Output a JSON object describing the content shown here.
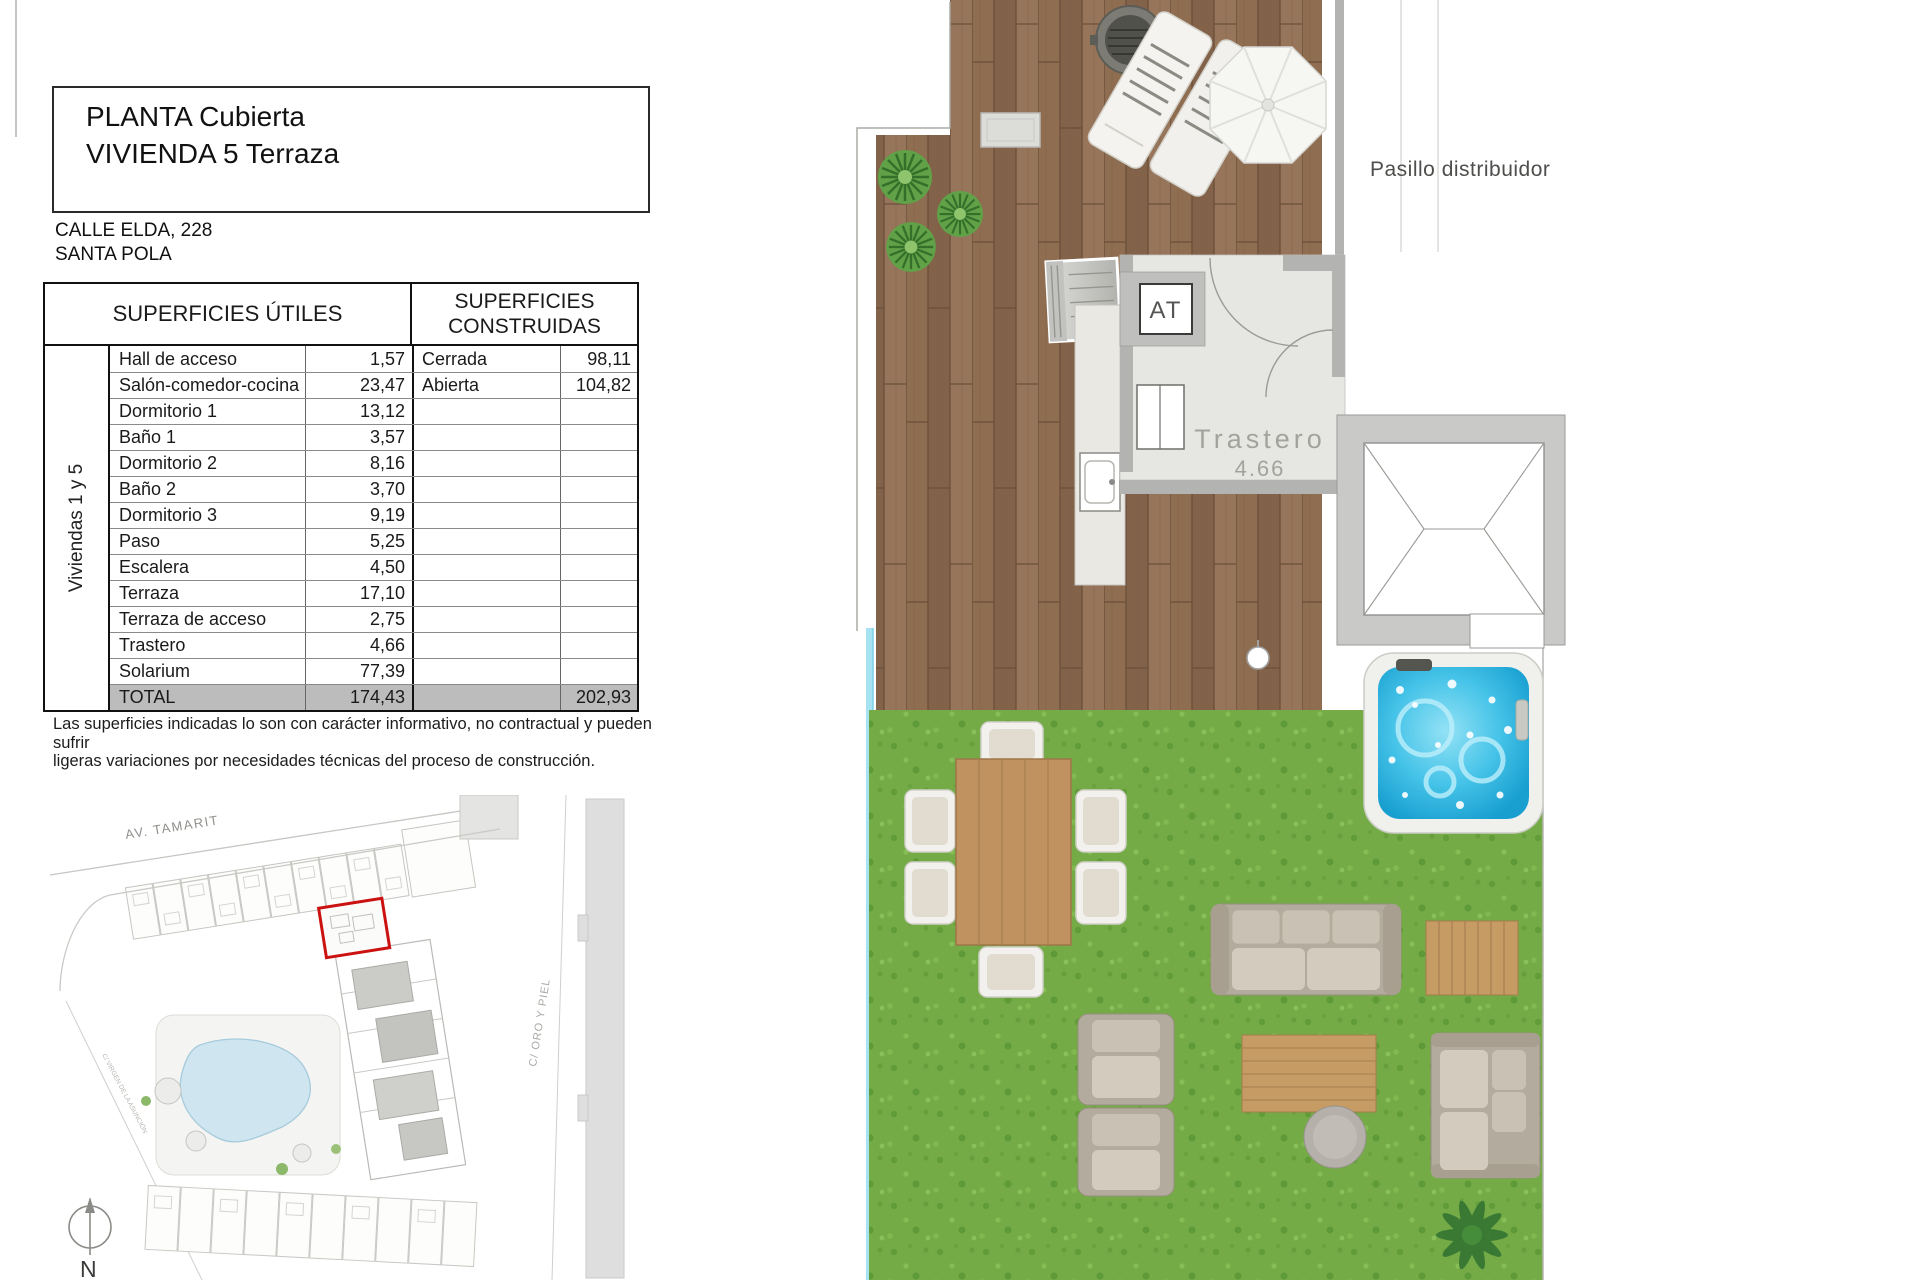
{
  "title_block": {
    "line1": "PLANTA Cubierta",
    "line2": "VIVIENDA 5 Terraza"
  },
  "address": {
    "line1": "CALLE ELDA, 228",
    "line2": "SANTA POLA"
  },
  "areas_table": {
    "header_utiles": "SUPERFICIES ÚTILES",
    "header_construidas_line1": "SUPERFICIES",
    "header_construidas_line2": "CONSTRUIDAS",
    "group_label": "Viviendas 1 y 5",
    "rows": [
      {
        "name": "Hall de acceso",
        "value": "1,57",
        "cname": "Cerrada",
        "cvalue": "98,11"
      },
      {
        "name": "Salón-comedor-cocina",
        "value": "23,47",
        "cname": "Abierta",
        "cvalue": "104,82"
      },
      {
        "name": "Dormitorio 1",
        "value": "13,12",
        "cname": "",
        "cvalue": ""
      },
      {
        "name": "Baño 1",
        "value": "3,57",
        "cname": "",
        "cvalue": ""
      },
      {
        "name": "Dormitorio 2",
        "value": "8,16",
        "cname": "",
        "cvalue": ""
      },
      {
        "name": "Baño 2",
        "value": "3,70",
        "cname": "",
        "cvalue": ""
      },
      {
        "name": "Dormitorio 3",
        "value": "9,19",
        "cname": "",
        "cvalue": ""
      },
      {
        "name": "Paso",
        "value": "5,25",
        "cname": "",
        "cvalue": ""
      },
      {
        "name": "Escalera",
        "value": "4,50",
        "cname": "",
        "cvalue": ""
      },
      {
        "name": "Terraza",
        "value": "17,10",
        "cname": "",
        "cvalue": ""
      },
      {
        "name": "Terraza de acceso",
        "value": "2,75",
        "cname": "",
        "cvalue": ""
      },
      {
        "name": "Trastero",
        "value": "4,66",
        "cname": "",
        "cvalue": ""
      },
      {
        "name": "Solarium",
        "value": "77,39",
        "cname": "",
        "cvalue": ""
      }
    ],
    "total": {
      "label": "TOTAL",
      "value": "174,43",
      "cvalue": "202,93"
    }
  },
  "disclaimer": {
    "line1": "Las superficies indicadas lo son con carácter informativo, no contractual y pueden sufrir",
    "line2": "ligeras variaciones por necesidades técnicas del proceso de construcción."
  },
  "site_plan": {
    "street_top": "AV. TAMARIT",
    "street_right": "C/ ORO Y PIEL",
    "street_left": "C/ VIRGEN DE LA ASUNCIÓN",
    "north_label": "N"
  },
  "floor_plan": {
    "corridor_label": "Pasillo distribuidor",
    "at_label": "AT",
    "storage_label": "Trastero",
    "storage_area": "4.66"
  },
  "colors": {
    "deck_wood": "#8d6b4e",
    "grass": "#74ab47",
    "jacuzzi_water": "#45c3e8",
    "highlight_red": "#cc1111",
    "total_row_gray": "#bcbcbc"
  }
}
